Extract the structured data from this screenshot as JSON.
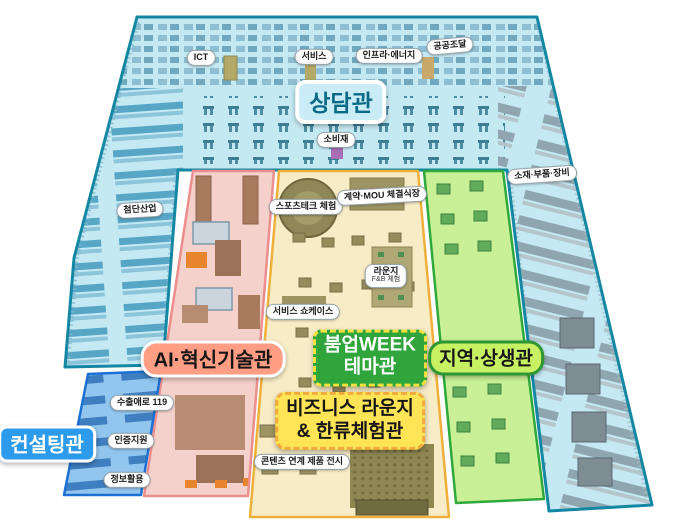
{
  "colors": {
    "background": "#FFFFFF",
    "counseling_fill": "#C5E9F3",
    "counseling_stroke": "#1687A3",
    "ai_fill": "#F4D1CB",
    "ai_stroke": "#EC8E8D",
    "theme_fill": "#F7ECC6",
    "theme_stroke": "#EFAF3B",
    "region_fill": "#C9F097",
    "region_stroke": "#2FA93B",
    "consulting_fill": "#92C6EE",
    "consulting_stroke": "#1D71D2",
    "label_counseling_bg": "#C9ECF7",
    "label_counseling_text": "#0B6B86",
    "label_ai_bg": "#FF9E85",
    "label_theme_bg": "#2FA53C",
    "label_theme_border": "#F2E13E",
    "label_business_bg": "#FFE455",
    "label_business_border": "#F2AA3C",
    "label_region_bg": "#C7F163",
    "label_region_border": "#2E9633",
    "label_consulting_bg": "#2D9BEB"
  },
  "zone_labels": {
    "counseling": "상담관",
    "ai": "AI·혁신기술관",
    "theme_line1": "붐업WEEK",
    "theme_line2": "테마관",
    "business_line1": "비즈니스 라운지",
    "business_line2": "& 한류체험관",
    "region": "지역·상생관",
    "consulting": "컨설팅관"
  },
  "area_pills": [
    {
      "text": "ICT"
    },
    {
      "text": "서비스"
    },
    {
      "text": "인프라·에너지"
    },
    {
      "text": "공공조달"
    },
    {
      "text": "소비재"
    },
    {
      "text": "소재·부품·장비"
    },
    {
      "text": "첨단산업"
    },
    {
      "text": "스포츠테크 체험"
    },
    {
      "text": "계약·MOU 체결식장"
    },
    {
      "text": "라운지",
      "sub": "F&B 체험"
    },
    {
      "text": "서비스 쇼케이스"
    },
    {
      "text": "콘텐츠 연계 제품 전시"
    },
    {
      "text": "수출애로 119"
    },
    {
      "text": "인증지원"
    },
    {
      "text": "정보활용"
    }
  ]
}
